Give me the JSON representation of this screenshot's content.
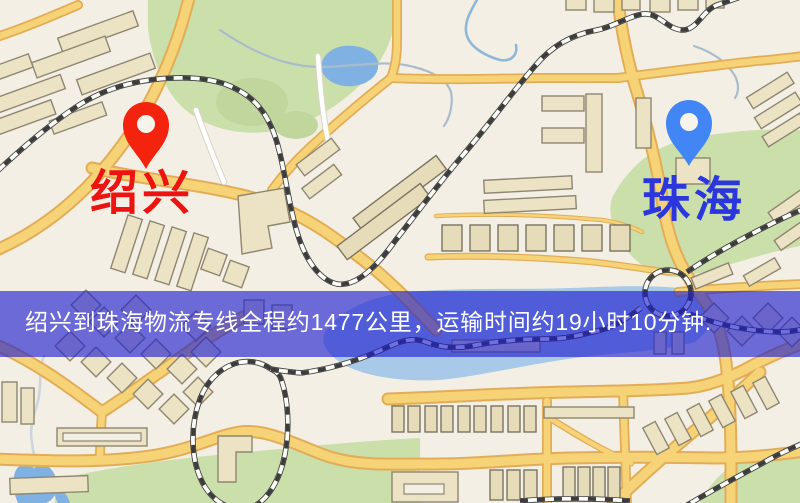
{
  "map_image": {
    "origin_marker": {
      "label": "绍兴",
      "pin_icon": "red-map-pin-icon",
      "pin_color": "#f3230e",
      "label_color": "#ed1310"
    },
    "destination_marker": {
      "label": "珠海",
      "pin_icon": "blue-map-pin-icon",
      "pin_color": "#4285f4",
      "label_color": "#2b36dd"
    },
    "caption_banner": {
      "text": "绍兴到珠海物流专线全程约1477公里，运输时间约19小时10分钟.",
      "background_color": "rgba(28,28,208,0.63)",
      "text_color": "#ffffff"
    },
    "route": {
      "origin": "绍兴",
      "destination": "珠海",
      "distance_text": "约1477公里",
      "duration_text": "约19小时10分钟"
    }
  }
}
